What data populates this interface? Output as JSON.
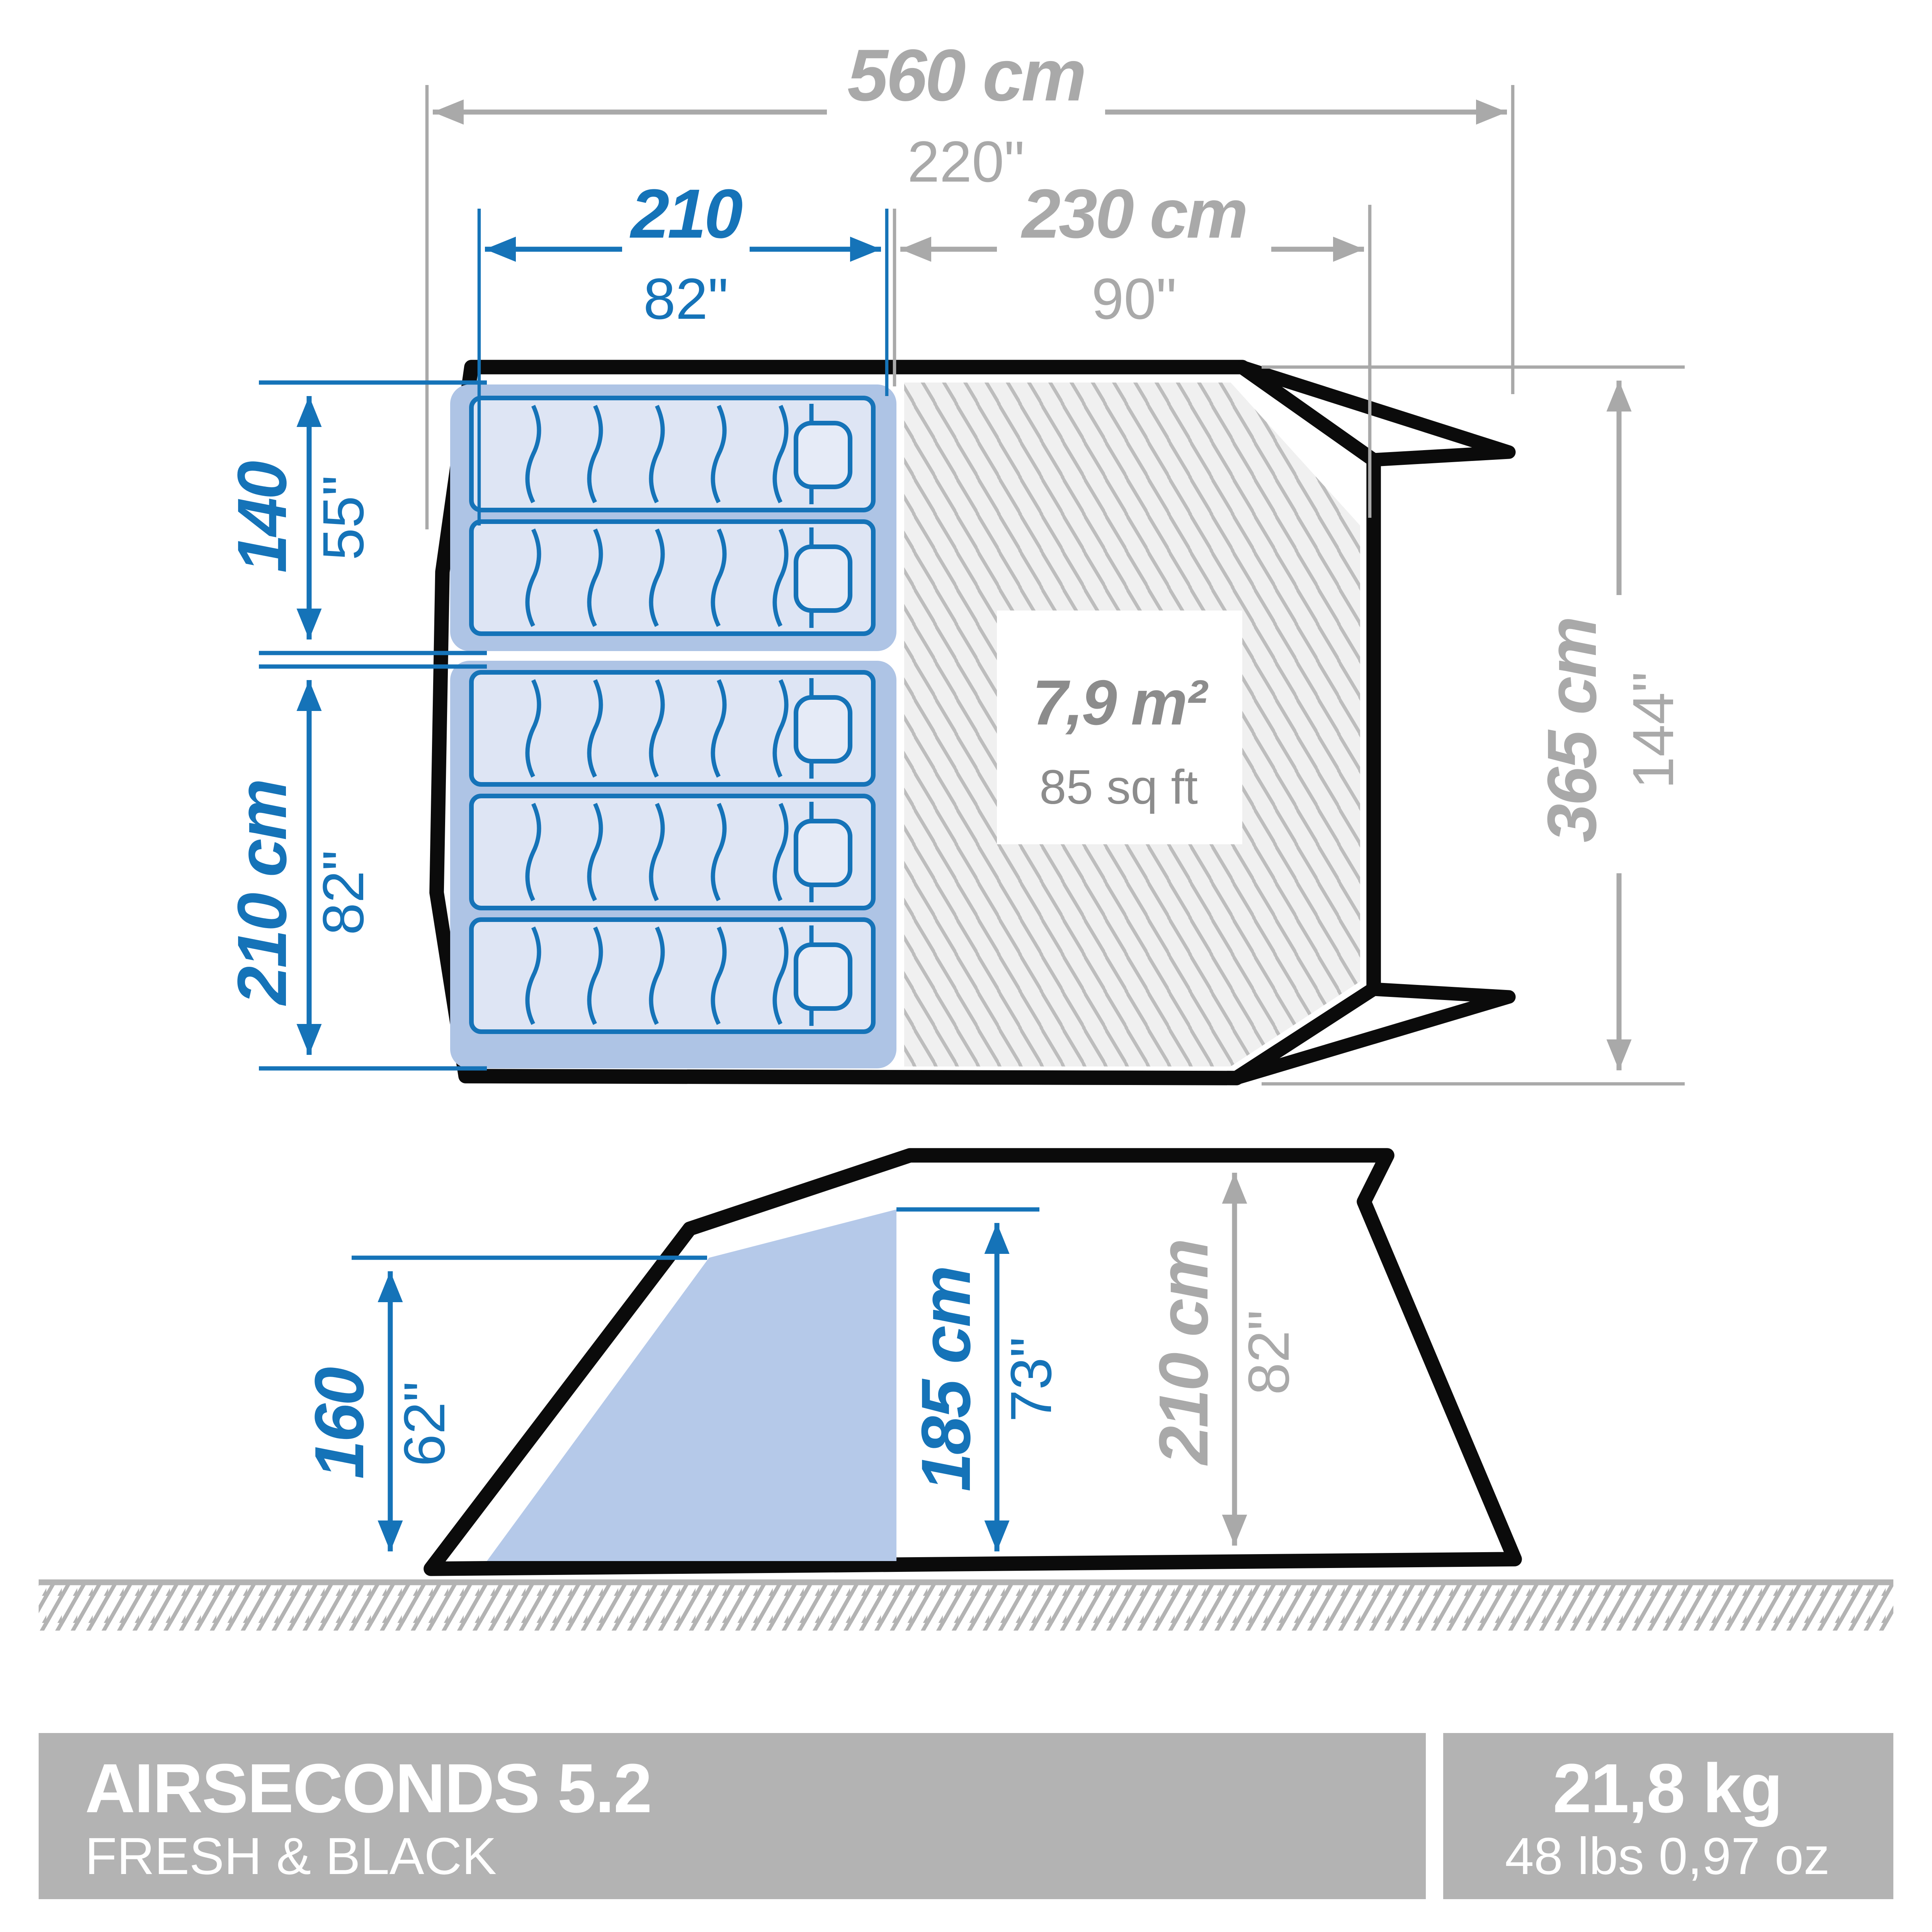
{
  "colors": {
    "accent_blue": "#1573b8",
    "dimension_gray": "#a9a9a9",
    "area_text_gray": "#8c8c8c",
    "outline_black": "#0b0b0b",
    "bedroom_fill": "#aec4e5",
    "mattress_fill": "#dee5f4",
    "footer_bar_gray": "#b3b3b3",
    "hatch_background": "#f0f0f0"
  },
  "plan": {
    "width_total": {
      "cm": "560 cm",
      "in": "220\""
    },
    "bedroom_width": {
      "cm": "210",
      "in": "82\""
    },
    "living_width": {
      "cm": "230 cm",
      "in": "90\""
    },
    "depth_total": {
      "cm": "365 cm",
      "in": "144\""
    },
    "bedroom_small_depth": {
      "cm": "140",
      "in": "55\""
    },
    "bedroom_large_depth": {
      "cm": "210 cm",
      "in": "82\""
    },
    "living_area": {
      "metric": "7,9 m²",
      "imperial": "85 sq ft"
    }
  },
  "side": {
    "bedroom_height": {
      "cm": "160",
      "in": "62\""
    },
    "interior_height": {
      "cm": "185 cm",
      "in": "73\""
    },
    "peak_height": {
      "cm": "210 cm",
      "in": "82\""
    }
  },
  "footer": {
    "product_name": "AIRSECONDS 5.2",
    "product_variant": "FRESH & BLACK",
    "weight_metric": "21,8 kg",
    "weight_imperial": "48 lbs 0,97 oz"
  }
}
